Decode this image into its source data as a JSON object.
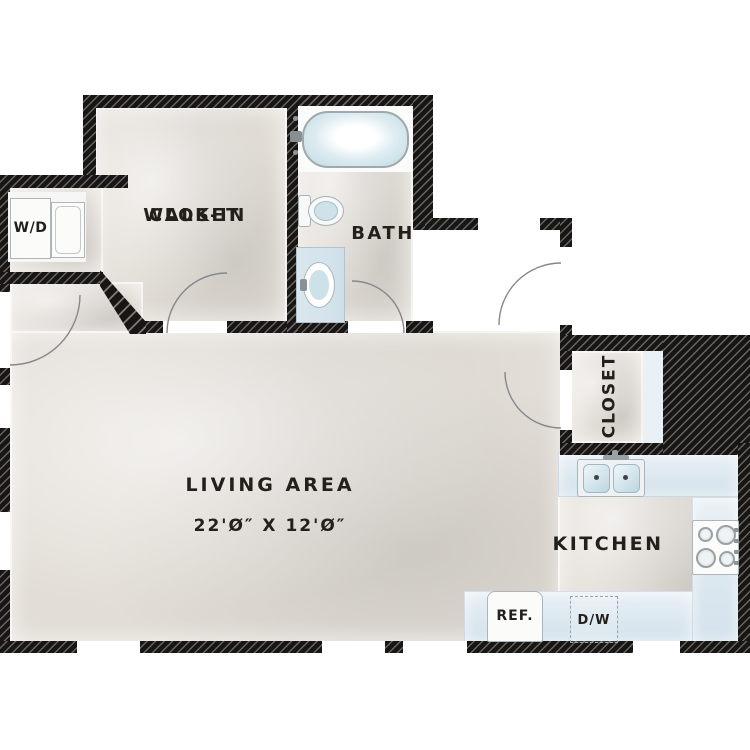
{
  "floorplan": {
    "rooms": {
      "walk_in_closet": {
        "line1": "WALK-IN",
        "line2": "CLOSET"
      },
      "bath": {
        "label": "BATH"
      },
      "living_area": {
        "label": "LIVING AREA",
        "dimensions": "22'Ø″ X 12'Ø″"
      },
      "kitchen": {
        "label": "KITCHEN"
      },
      "closet": {
        "label": "CLOSET"
      }
    },
    "appliances": {
      "washer_dryer": {
        "label": "W/D"
      },
      "refrigerator": {
        "label": "REF."
      },
      "dishwasher": {
        "label": "D/W"
      }
    },
    "colors": {
      "wall": "#171615",
      "hatch": "#b9b4aa",
      "floor": "#e2ddd6",
      "counter": "#dbe7ef",
      "fixture_blue": "#c7dde6",
      "text": "#23201c"
    }
  }
}
